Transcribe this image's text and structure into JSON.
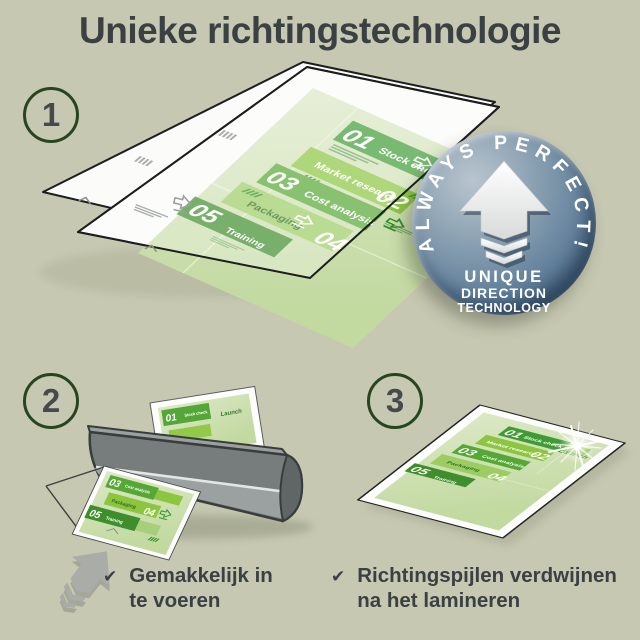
{
  "title": "Unieke richtingstechnologie",
  "steps": [
    {
      "number": "1"
    },
    {
      "number": "2"
    },
    {
      "number": "3"
    }
  ],
  "badge": {
    "arc_text": "ALWAYS PERFECT!",
    "lines": [
      "UNIQUE",
      "DIRECTION",
      "TECHNOLOGY"
    ]
  },
  "infographic": {
    "corner_label": "Launch",
    "items": [
      {
        "num": "01",
        "label": "Stock check"
      },
      {
        "num": "02",
        "label": "Market research"
      },
      {
        "num": "03",
        "label": "Cost analysis"
      },
      {
        "num": "04",
        "label": "Packaging"
      },
      {
        "num": "05",
        "label": "Training"
      }
    ]
  },
  "checklist": {
    "check_glyph": "✔",
    "items": [
      {
        "line1": "Gemakkelijk in",
        "line2": "te voeren"
      },
      {
        "line1": "Richtingspijlen verdwijnen",
        "line2": "na het lamineren"
      }
    ]
  },
  "colors": {
    "background": "#c6c8b1",
    "title_text": "#3b4043",
    "step_circle_border": "#27461f",
    "step_number": "#464a4c",
    "badge_face": "#64829d",
    "badge_text": "#ffffff",
    "doc_green_dark": "#3f9c35",
    "doc_green_mid": "#55a833",
    "doc_green_light": "#8cc63f",
    "doc_green_pale": "#9ccd63",
    "doc_sheet": "#d4e3b4",
    "launch_text": "#2f7a26",
    "laminator_gray": "#7a8180",
    "arrow_gray": "#a9aca7"
  }
}
